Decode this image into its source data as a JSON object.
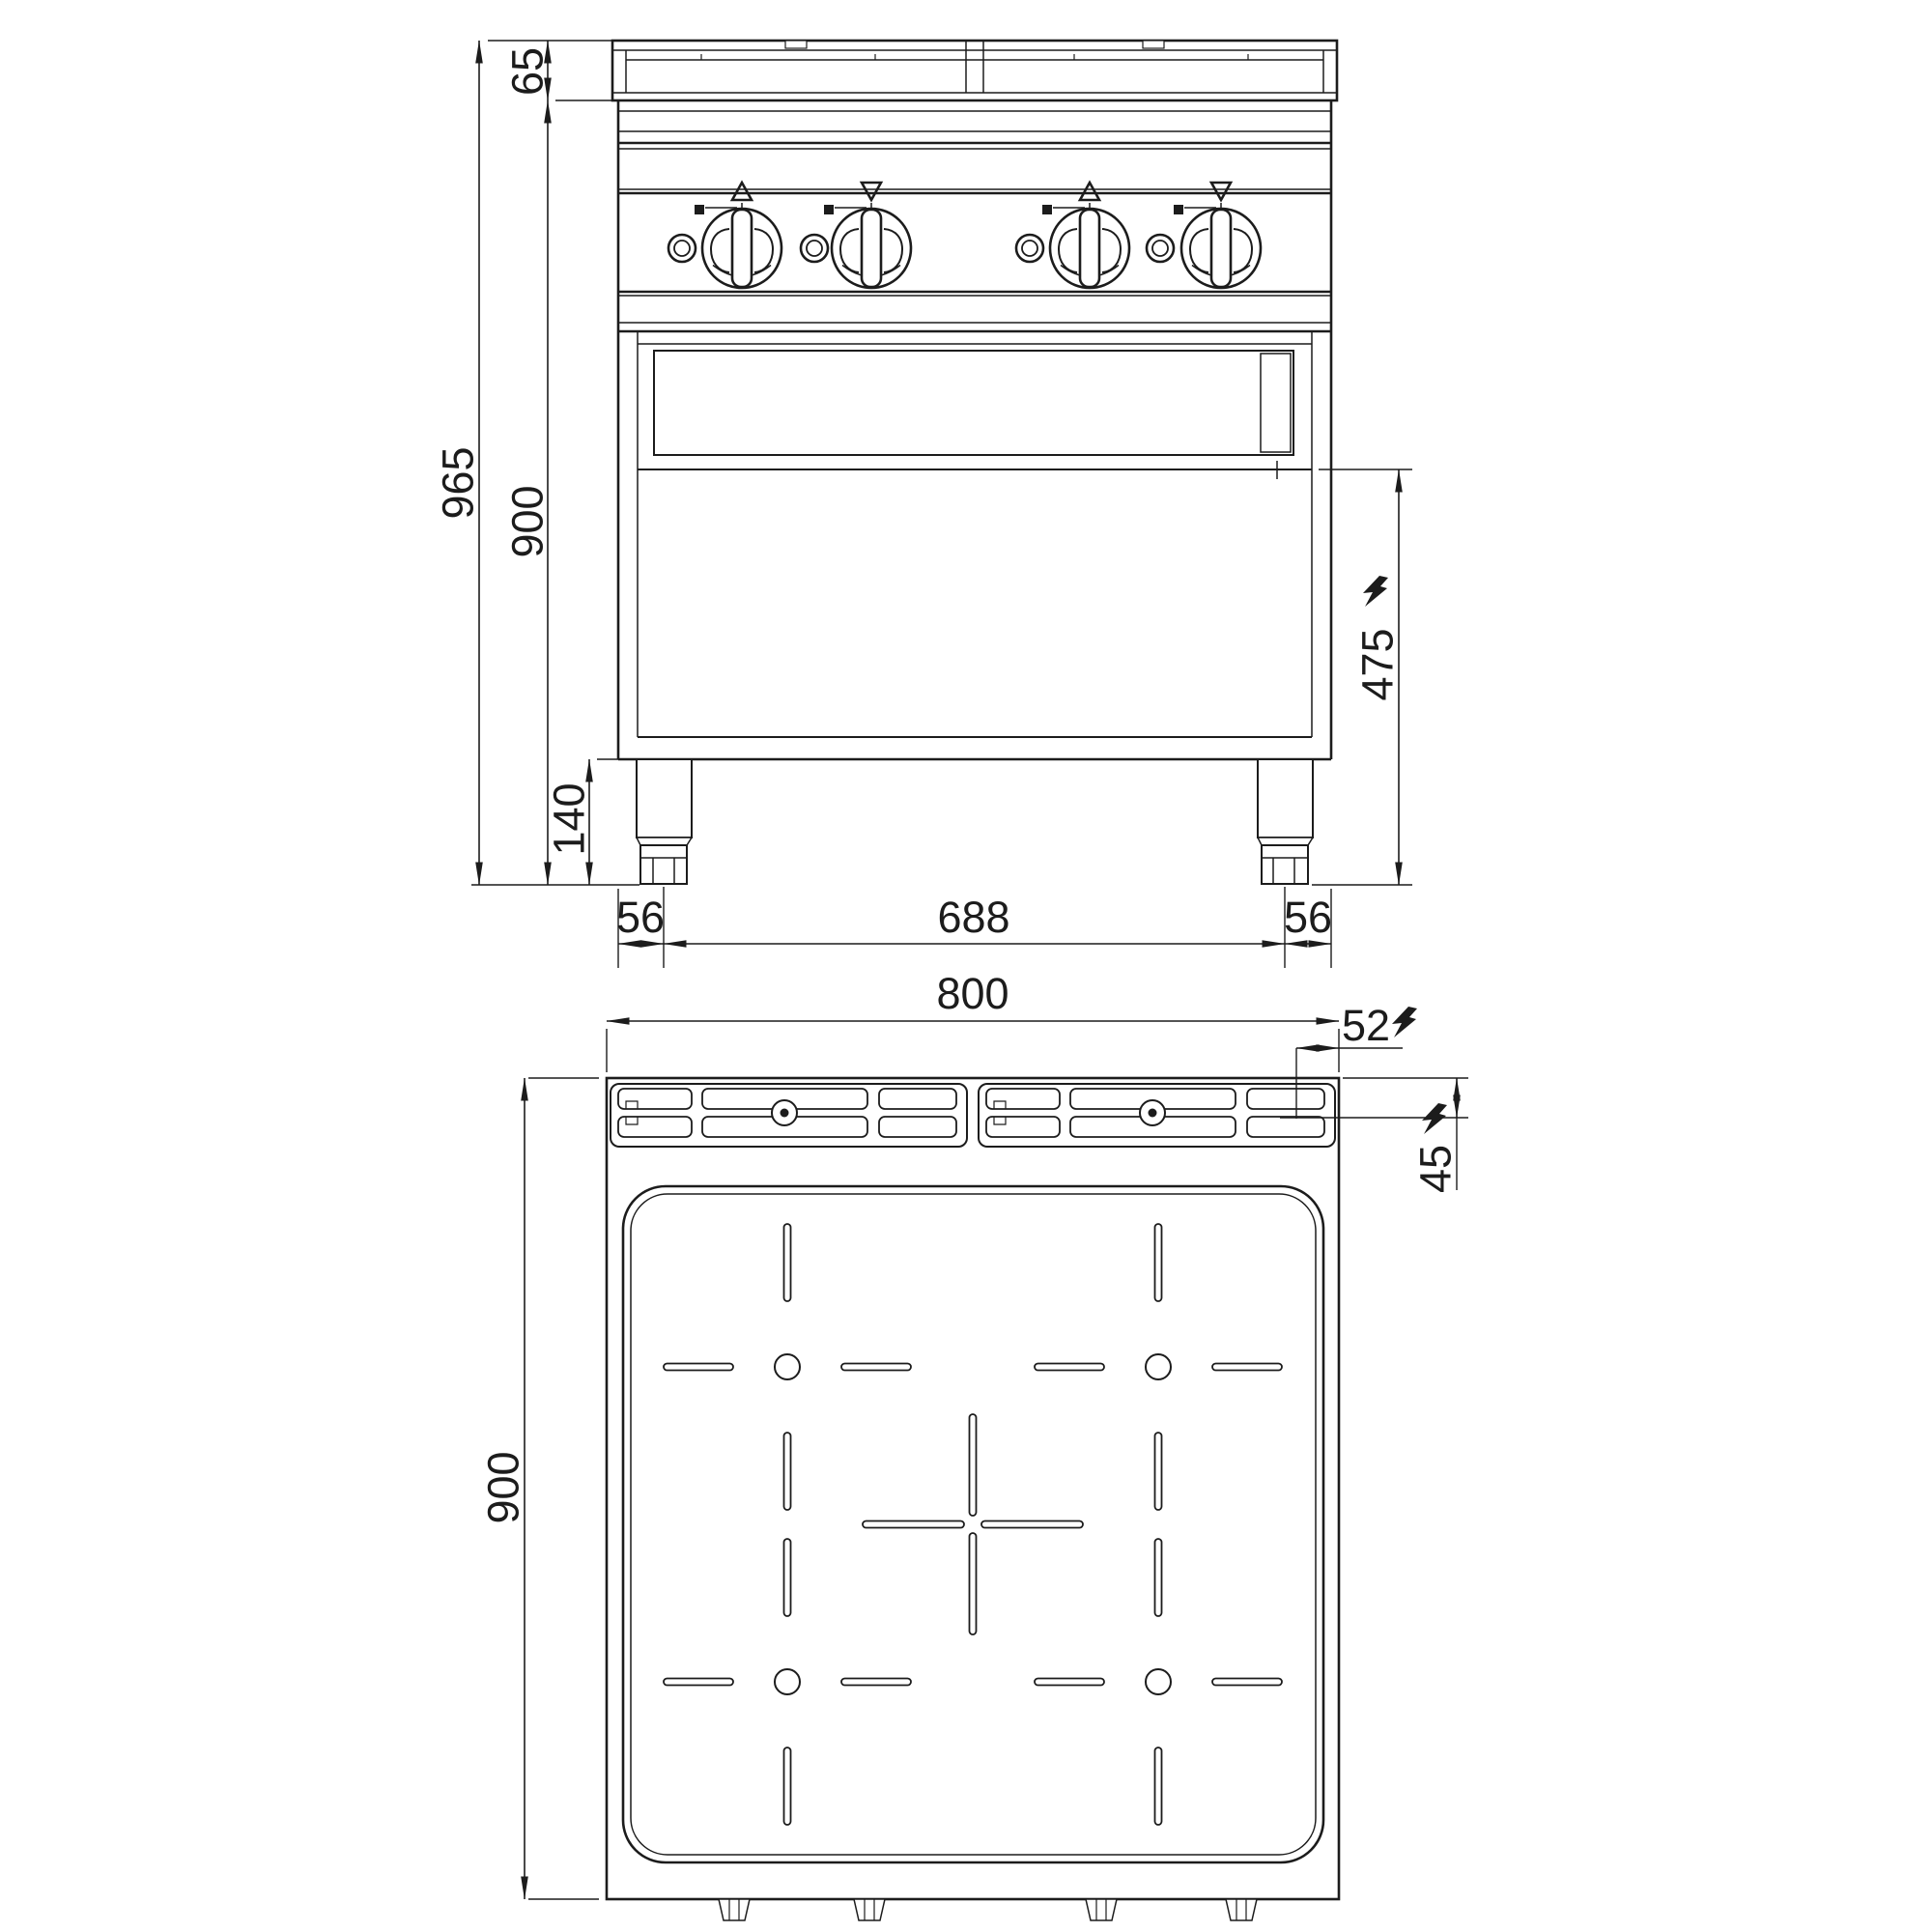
{
  "colors": {
    "background": "#ffffff",
    "line": "#1c1c1c"
  },
  "dims": {
    "front": {
      "backsplash_height": "65",
      "total_height": "965",
      "worktop_height": "900",
      "leg_height": "140",
      "foot_inset_left": "56",
      "foot_spacing": "688",
      "foot_inset_right": "56",
      "electric_connection_height": "475"
    },
    "top": {
      "width": "800",
      "depth": "900",
      "electric_offset_right": "52",
      "electric_offset_back": "45"
    }
  }
}
